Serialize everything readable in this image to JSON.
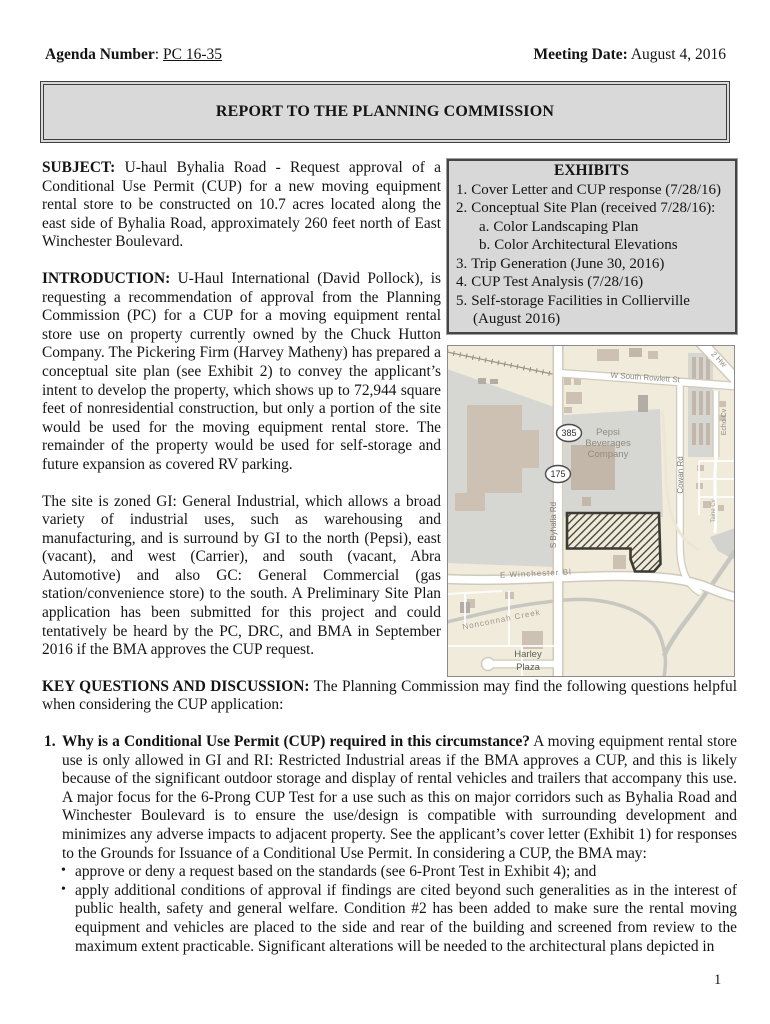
{
  "header": {
    "agenda_label": "Agenda Number",
    "agenda_separator": ": ",
    "agenda_value": "PC 16-35",
    "meeting_label": "Meeting Date:",
    "meeting_value": "August 4, 2016"
  },
  "report_title": "REPORT TO THE PLANNING COMMISSION",
  "subject": {
    "label": "SUBJECT:",
    "text": "U-haul Byhalia Road - Request approval of a Conditional Use Permit (CUP) for a new moving equipment rental store to be constructed on 10.7 acres located along the east side of Byhalia Road, approximately 260 feet north of East Winchester Boulevard."
  },
  "introduction": {
    "label": "INTRODUCTION:",
    "text": "U-Haul International (David Pollock), is requesting a recommendation of approval from the Planning Commission (PC) for a CUP for a moving equipment rental store use on property currently owned by the Chuck Hutton Company. The Pickering Firm (Harvey Matheny) has prepared a conceptual site plan (see Exhibit 2) to convey the applicant’s intent to develop the property, which shows up to 72,944 square feet of nonresidential construction, but only a portion of the site would be used for the moving equipment rental store. The remainder of the property would be used for self-storage and future expansion as covered RV parking."
  },
  "zoning_text": "The site is zoned GI: General Industrial, which allows a broad variety of industrial uses, such as warehousing and manufacturing, and is surround by GI to the north (Pepsi), east (vacant), and west (Carrier), and south (vacant, Abra Automotive) and also GC: General Commercial (gas station/convenience store) to the south. A Preliminary Site Plan application has been submitted for this project and could tentatively be heard by the PC, DRC, and BMA in September 2016 if the BMA approves the CUP request.",
  "key_questions": {
    "label": "KEY QUESTIONS AND DISCUSSION:",
    "text": "The Planning Commission may find the following questions helpful when considering the CUP application:"
  },
  "question1": {
    "number": "1.",
    "bold_lead": "Why is a Conditional Use Permit (CUP) required in this circumstance?",
    "text": "A moving equipment rental store use is only allowed in GI and RI: Restricted Industrial areas if the BMA approves a CUP, and this is likely because of the significant outdoor storage and display of rental vehicles and trailers that accompany this use. A major focus for the 6-Prong CUP Test for a use such as this on major corridors such as Byhalia Road and Winchester Boulevard is to ensure the use/design is compatible with surrounding development and minimizes any adverse impacts to adjacent property. See the applicant’s cover letter (Exhibit 1) for responses to the Grounds for Issuance of a Conditional Use Permit. In considering a CUP, the BMA may:",
    "bullet_char": "•",
    "bullets": [
      "approve or deny a request based on the standards (see 6-Pront Test in Exhibit 4);  and",
      "apply additional conditions of approval if findings are cited beyond such generalities as in the interest of public health, safety and general welfare. Condition #2 has been added to make sure the rental moving equipment and vehicles are placed to the side and rear of the building and screened from review to the maximum extent practicable. Significant alterations will be needed to the architectural plans depicted in"
    ]
  },
  "exhibits": {
    "title": "EXHIBITS",
    "items": [
      {
        "num": "1.",
        "text": "Cover Letter and CUP response (7/28/16)"
      },
      {
        "num": "2.",
        "text": "Conceptual Site Plan (received 7/28/16):"
      },
      {
        "num": "a.",
        "text": "Color Landscaping Plan"
      },
      {
        "num": "b.",
        "text": "Color  Architectural Elevations"
      },
      {
        "num": "3.",
        "text": "Trip Generation (June 30, 2016)"
      },
      {
        "num": "4.",
        "text": "CUP Test Analysis (7/28/16)"
      },
      {
        "num": "5.",
        "text": "Self-storage Facilities in Collierville (August 2016)"
      }
    ]
  },
  "map": {
    "shield_385": "385",
    "shield_175": "175",
    "labels": {
      "rowlett": "W South Rowlett St",
      "highway": "2 Hw",
      "pepsi_line1": "Pepsi",
      "pepsi_line2": "Beverages",
      "pepsi_line3": "Company",
      "byhalia": "S Byhalia Rd",
      "cowan": "Cowan Rd",
      "echo": "Echo Cv",
      "taine": "Taine Cv",
      "winchester": "E Winchester Bl",
      "creek": "Nonconnah Creek",
      "harley_line1": "Harley",
      "harley_line2": "Plaza"
    },
    "colors": {
      "land": "#f1ebdb",
      "industrial_gray": "#d6d6d2",
      "building_tan": "#cdc1b4",
      "road_white": "#ffffff",
      "site_outline": "#3c3b35"
    }
  },
  "page_number": "1"
}
